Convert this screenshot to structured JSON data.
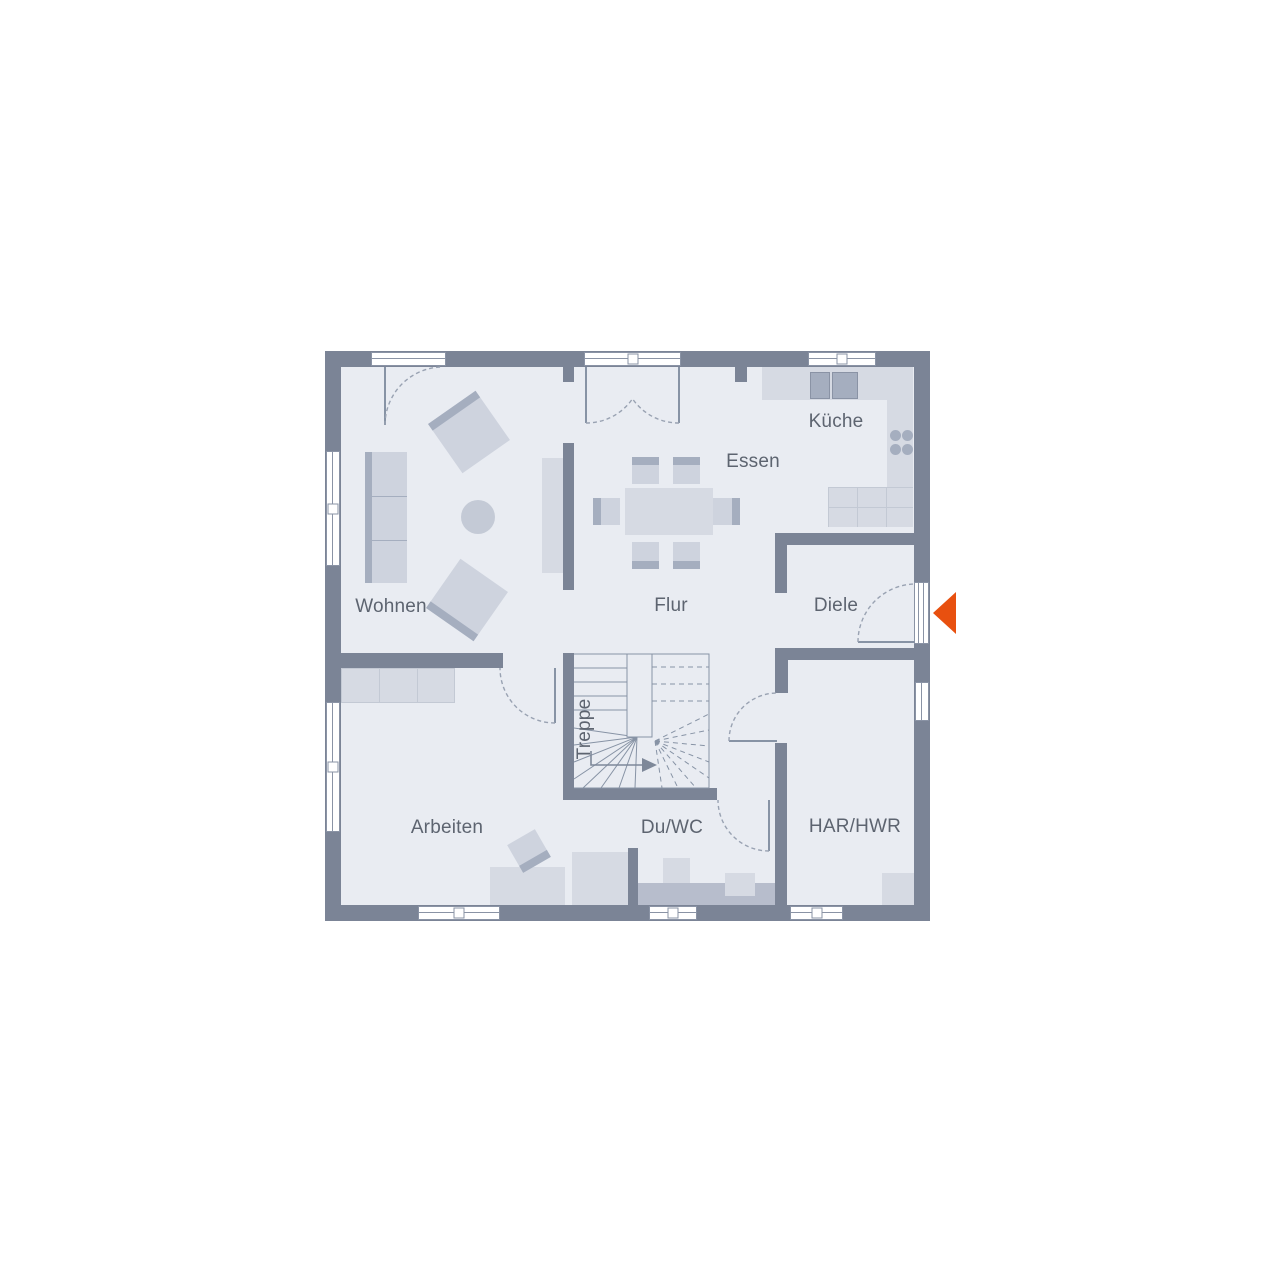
{
  "plan": {
    "type": "floor-plan",
    "rooms": [
      {
        "id": "kueche",
        "label": "Küche"
      },
      {
        "id": "essen",
        "label": "Essen"
      },
      {
        "id": "wohnen",
        "label": "Wohnen"
      },
      {
        "id": "flur",
        "label": "Flur"
      },
      {
        "id": "diele",
        "label": "Diele"
      },
      {
        "id": "treppe",
        "label": "Treppe"
      },
      {
        "id": "arbeiten",
        "label": "Arbeiten"
      },
      {
        "id": "duwc",
        "label": "Du/WC"
      },
      {
        "id": "harhwr",
        "label": "HAR/HWR"
      }
    ],
    "entrance": {
      "symbol": "triangle-arrow-left"
    },
    "colors": {
      "wall": "#7b8496",
      "floor": "#e9ecf2",
      "furn": "#ced3de",
      "furnDark": "#a5aebf",
      "counter": "#d6dae3",
      "counterLine": "#c3c9d4",
      "line": "#8a93a5",
      "label": "#5d6470",
      "accent": "#e8500f",
      "window": "#ffffff"
    }
  }
}
